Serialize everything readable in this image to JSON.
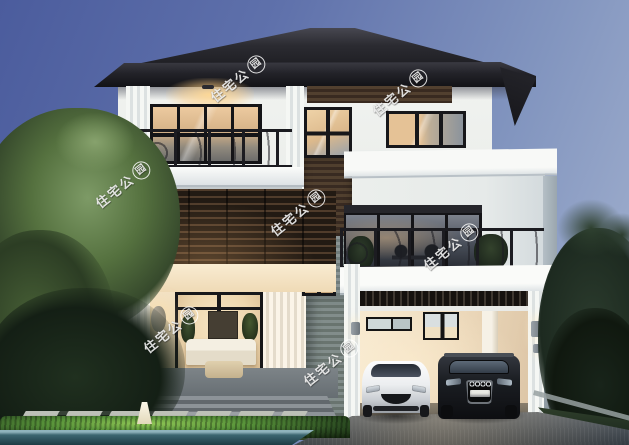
{
  "watermark": {
    "chars": "住宅公",
    "circled_char": "园",
    "instances": [
      {
        "x": 250,
        "y": 79
      },
      {
        "x": 412,
        "y": 93
      },
      {
        "x": 135,
        "y": 185
      },
      {
        "x": 310,
        "y": 213
      },
      {
        "x": 463,
        "y": 247
      },
      {
        "x": 183,
        "y": 330
      },
      {
        "x": 343,
        "y": 363
      }
    ]
  },
  "palette": {
    "sky_top": "#4b5c9d",
    "sky_bottom": "#a6b4d0",
    "roof": "#26262b",
    "wall_white": "#eef0ed",
    "wood_brown": "#4a392e",
    "louver_dark": "#2a211b",
    "warm_light": "#f6dfae",
    "railing_metal": "#1a1a1f",
    "hedge_green": "#6fae45",
    "driveway_gray": "#4c535a",
    "pool_teal": "#2a4e59",
    "car_white": "#f2f3f4",
    "car_black": "#111316"
  }
}
